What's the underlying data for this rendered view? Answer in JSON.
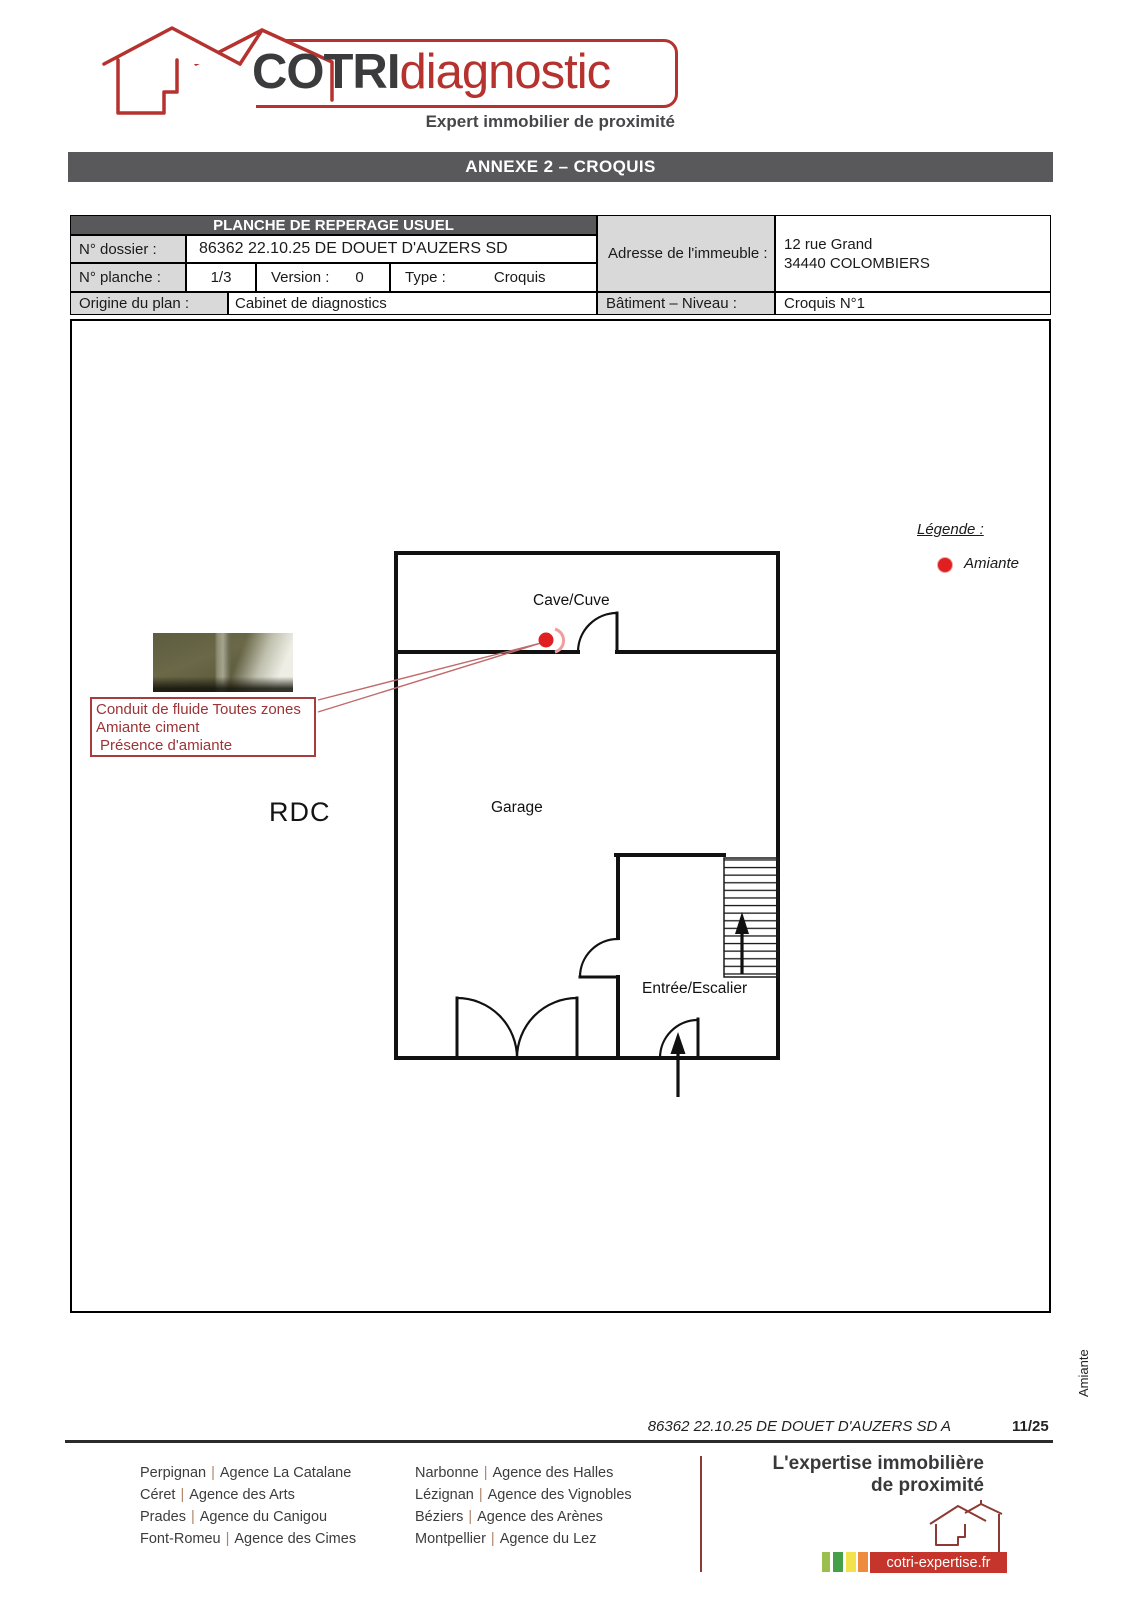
{
  "logo": {
    "brand_bold": "COTRI",
    "brand_light": "diagnostic",
    "tagline": "Expert immobilier de proximité"
  },
  "banner": {
    "title": "ANNEXE 2 – CROQUIS"
  },
  "info_table": {
    "header": "PLANCHE DE REPERAGE USUEL",
    "dossier_label": "N° dossier :",
    "dossier_value": "86362 22.10.25 DE DOUET D'AUZERS SD",
    "planche_label": "N° planche :",
    "planche_value": "1/3",
    "version_label": "Version :",
    "version_value": "0",
    "type_label": "Type :",
    "type_value": "Croquis",
    "adresse_label": "Adresse de l'immeuble :",
    "adresse_line1": "12 rue Grand",
    "adresse_line2": "34440 COLOMBIERS",
    "origine_label": "Origine du plan :",
    "origine_value": "Cabinet de diagnostics",
    "batiment_label": "Bâtiment – Niveau :",
    "batiment_value": "Croquis N°1"
  },
  "legend": {
    "title": "Légende :",
    "item": "Amiante",
    "marker_color": "#e02020"
  },
  "plan": {
    "floor_label": "RDC",
    "room_cave": "Cave/Cuve",
    "room_garage": "Garage",
    "room_entree": "Entrée/Escalier",
    "annotation": {
      "line1": "Conduit de fluide Toutes zones",
      "line2": "Amiante ciment",
      "line3": "Présence d'amiante"
    },
    "side_label": "Amiante"
  },
  "page_footer": {
    "reference": "86362 22.10.25 DE DOUET D'AUZERS SD A",
    "page": "11/25"
  },
  "footer": {
    "separator": "|",
    "agencies_col1": [
      {
        "city": "Perpignan",
        "agency": "Agence La Catalane"
      },
      {
        "city": "Céret",
        "agency": "Agence des Arts"
      },
      {
        "city": "Prades",
        "agency": "Agence du Canigou"
      },
      {
        "city": "Font-Romeu",
        "agency": "Agence des Cimes"
      }
    ],
    "agencies_col2": [
      {
        "city": "Narbonne",
        "agency": "Agence des Halles"
      },
      {
        "city": "Lézignan",
        "agency": "Agence des Vignobles"
      },
      {
        "city": "Béziers",
        "agency": "Agence des Arènes"
      },
      {
        "city": "Montpellier",
        "agency": "Agence du Lez"
      }
    ],
    "tagline_line1": "L'expertise immobilière",
    "tagline_line2": "de proximité",
    "website": "cotri-expertise.fr",
    "bar_colors": [
      "#9bbf4e",
      "#45a049",
      "#f2e34c",
      "#ee8b3c"
    ],
    "accent_colors": {
      "maroon": "#8e3a34",
      "website_box": "#c5352c",
      "brand_red": "#b5322e",
      "banner_gray": "#59595b"
    }
  }
}
